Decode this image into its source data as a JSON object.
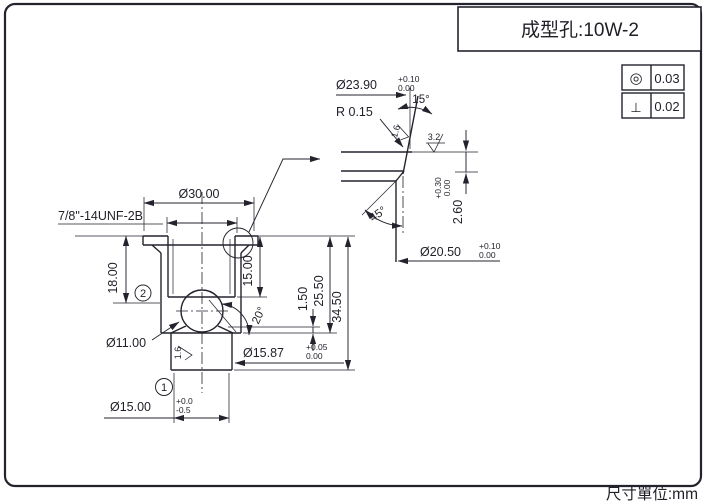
{
  "frame": {
    "units_note": "尺寸單位:mm"
  },
  "title_block": {
    "label": "成型孔:10W-2"
  },
  "tolerance_table": {
    "rows": [
      {
        "symbol": "◎",
        "value": "0.03"
      },
      {
        "symbol": "⊥",
        "value": "0.02"
      }
    ]
  },
  "main_view": {
    "thread_callout": "7/8\"-14UNF-2B",
    "dia_flange": "Ø30.00",
    "depth_18": "18.00",
    "depth_15": "15.00",
    "dim_1_50": "1.50",
    "dim_25_50": "25.50",
    "dim_34_50": "34.50",
    "angle_cone": "20°",
    "dia_ball": "Ø11.00",
    "dia_shank": "Ø15.87",
    "dia_shank_tol_upper": "+0.05",
    "dia_shank_tol_lower": "0.00",
    "dia_tip": "Ø15.00",
    "dia_tip_tol_upper": "+0.0",
    "dia_tip_tol_lower": "-0.5",
    "roughness_shank": "1.6",
    "note_1": "1",
    "note_2": "2"
  },
  "detail_view": {
    "dia_mouth": "Ø23.90",
    "dia_mouth_tol_upper": "+0.10",
    "dia_mouth_tol_lower": "0.00",
    "angle_taper": "15°",
    "radius": "R 0.15",
    "roughness_taper": "1.6",
    "roughness_face": "3.2",
    "angle_chamfer": "45°",
    "depth_groove": "2.60",
    "depth_groove_tol_upper": "+0.30",
    "depth_groove_tol_lower": "0.00",
    "dia_groove": "Ø20.50",
    "dia_groove_tol_upper": "+0.10",
    "dia_groove_tol_lower": "0.00"
  }
}
